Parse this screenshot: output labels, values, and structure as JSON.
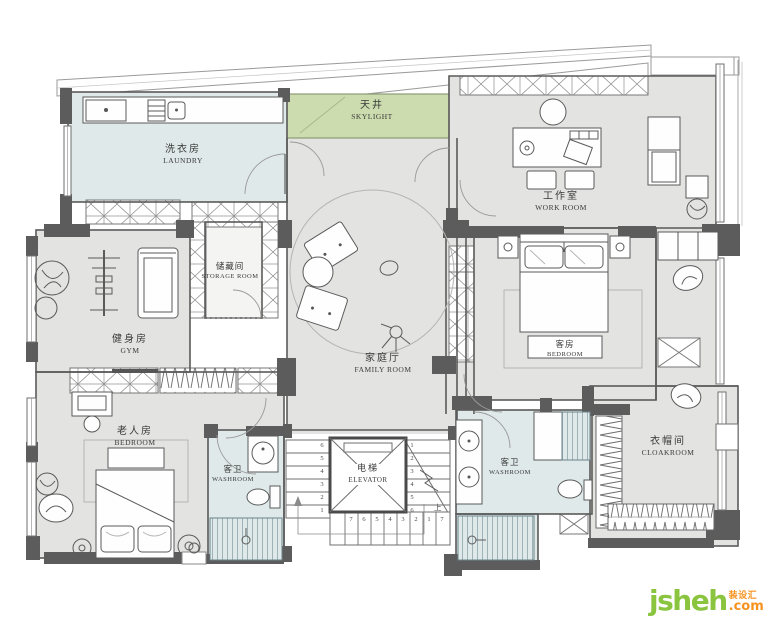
{
  "plan": {
    "rooms": [
      {
        "id": "laundry",
        "zh": "洗衣房",
        "en": "LAUNDRY"
      },
      {
        "id": "skylight",
        "zh": "天井",
        "en": "SKYLIGHT"
      },
      {
        "id": "work-room",
        "zh": "工作室",
        "en": "WORK ROOM"
      },
      {
        "id": "storage-room",
        "zh": "储藏间",
        "en": "STORAGE ROOM"
      },
      {
        "id": "gym",
        "zh": "健身房",
        "en": "GYM"
      },
      {
        "id": "family-room",
        "zh": "家庭厅",
        "en": "FAMILY ROOM"
      },
      {
        "id": "guest-bedroom",
        "zh": "客房",
        "en": "BEDROOM"
      },
      {
        "id": "elder-bedroom",
        "zh": "老人房",
        "en": "BEDROOM"
      },
      {
        "id": "washroom-1",
        "zh": "客卫",
        "en": "WASHROOM"
      },
      {
        "id": "elevator",
        "zh": "电梯",
        "en": "ELEVATOR"
      },
      {
        "id": "washroom-2",
        "zh": "客卫",
        "en": "WASHROOM"
      },
      {
        "id": "cloakroom",
        "zh": "衣帽间",
        "en": "CLOAKROOM"
      }
    ],
    "stairs": {
      "left": [
        "6",
        "5",
        "4",
        "3",
        "2",
        "1"
      ],
      "right": [
        "1",
        "2",
        "3",
        "4",
        "5",
        "6"
      ],
      "bottom": [
        "7",
        "6",
        "5",
        "4",
        "3",
        "2",
        "1",
        "7"
      ],
      "up": "上"
    },
    "colors": {
      "floor": "#e3e3e2",
      "wet_floor": "#dfe9e9",
      "skylight_green": "#ccdcae",
      "wall": "#5c5c5c",
      "line": "#6f6f6f"
    }
  },
  "logo": {
    "text": "jsheh",
    "suffix": ".com",
    "zh": "装设汇",
    "green": "#8bc53f",
    "orange": "#f6921e"
  }
}
